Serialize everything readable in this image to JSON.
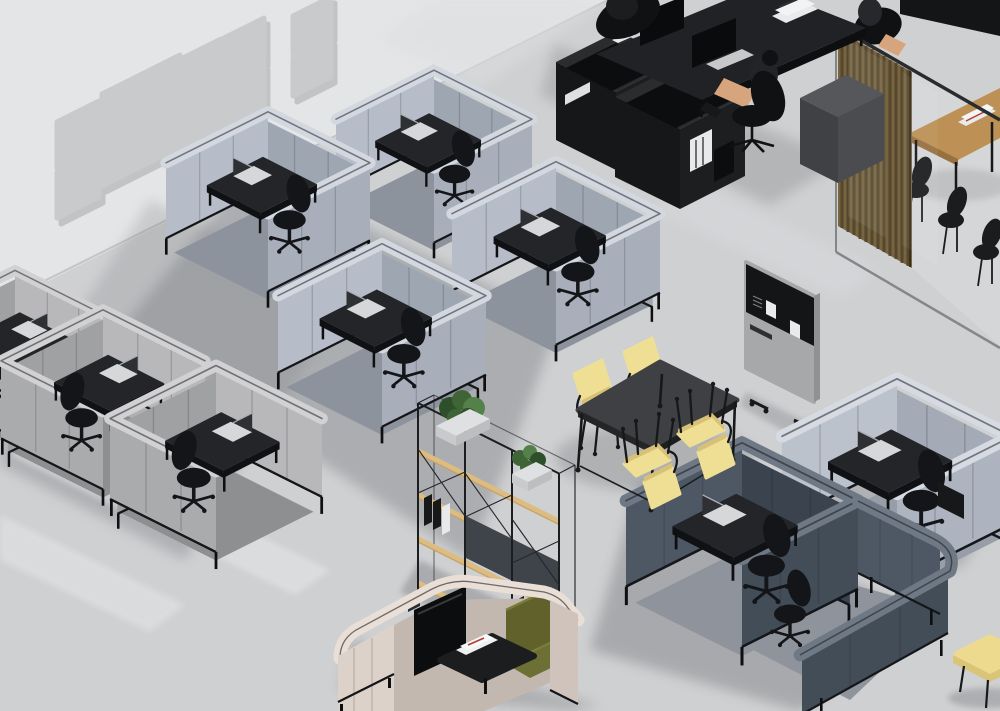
{
  "scene": {
    "title": "Isometric 3D render of an open-plan office with acoustic work pods",
    "view": "isometric top-down, no visible text",
    "objects": [
      {
        "name": "acoustic-wall-panels",
        "count": 9,
        "color": "#c9cacc"
      },
      {
        "name": "focus-pod-light-blue",
        "count": 5,
        "wall_color": "#b7bdc8",
        "top_color": "#d3d8e0",
        "contents": "black desk, laptop, black task chair"
      },
      {
        "name": "focus-pod-gray",
        "count": 3,
        "wall_color": "#b8b8ba",
        "contents": "black desk, black task chair"
      },
      {
        "name": "duo-pod-dark-blue",
        "count": 1,
        "wall_color": "#4e5864",
        "contents": "black desk, laptop, two black chairs"
      },
      {
        "name": "lounge-pod-blush",
        "count": 1,
        "wall_color": "#ddd2ca",
        "sofa_color": "#60612b",
        "contents": "olive sofa, black coffee table, magazines, wall screen"
      },
      {
        "name": "team-workstation-black",
        "count": 1,
        "color": "#1d1e20",
        "monitors": 2,
        "accessories": "shelf caddies, white binders, keyboard, books"
      },
      {
        "name": "glass-meeting-room",
        "table_color": "#bd9055",
        "slat_screen_color": "#776540",
        "black_chairs": 3,
        "extras": "magazines on table"
      },
      {
        "name": "plant-shelf-divider",
        "wood_color": "#dcbc80",
        "frame_color": "#1c1d1f",
        "plants": 2,
        "binders": "black and white"
      },
      {
        "name": "meeting-table-black",
        "count": 1,
        "top_color": "#3e4043",
        "yellow_chairs": 4,
        "chair_color": "#efdf94"
      },
      {
        "name": "mobile-pinboard-partition",
        "count": 1,
        "fabric_color": "#a6a8aa",
        "board_color": "#141517",
        "pinned_notes": 2
      },
      {
        "name": "office-chair-black",
        "count": 10,
        "color": "#141518"
      },
      {
        "name": "laptop",
        "count": 6,
        "color": "#d6d7d9"
      },
      {
        "name": "pouf-yellow",
        "count": 1,
        "color": "#edda8e"
      },
      {
        "name": "people-seated",
        "count": 2,
        "note": "partially visible at black workstations"
      }
    ]
  },
  "palette": {
    "floor": "#cfd0d2",
    "wall": "#e4e5e6",
    "panel": "#c9cacc",
    "panelShadow": "#a2a3a5",
    "desk": "#232528",
    "deskEdge": "#101114",
    "chair": "#141518",
    "laptopBody": "#d6d7d9",
    "laptopScreen": "#2e3033",
    "black": "#17181a",
    "white": "#eceded",
    "wood": "#bd9055",
    "woodEdge": "#97703f",
    "shelfWood": "#dcbc80",
    "shelfPanel": "#3f434a",
    "slat": "#776540",
    "slatLine": "#50432c",
    "yellow": "#efdf94",
    "yellowSide": "#d8c176",
    "sofa": "#60612b",
    "sofaSeat": "#6d7034",
    "partition": "#a6a8aa",
    "board": "#141517",
    "plantDark": "#2f4f2b",
    "plant": "#3f6536",
    "plantLight": "#548049",
    "planter": "#dfe0e1",
    "glassFrame": "#2a2b2d",
    "shadow": "#6f7175"
  },
  "canvas": {
    "width": 1000,
    "height": 711
  }
}
